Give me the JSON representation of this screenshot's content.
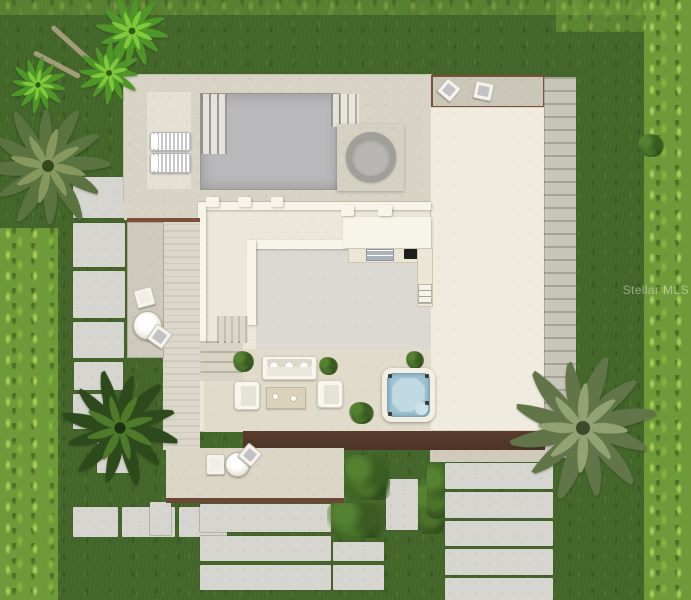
{
  "site": {
    "watermark": "Stellar MLS",
    "description": "Aerial 3D rendering of a modern single-family residence site plan",
    "areas": [
      "lawn",
      "pool-deck",
      "swimming-pool",
      "round-spa",
      "lounger-pad",
      "roof-terrace",
      "garage-wing",
      "main-residence",
      "outdoor-kitchen",
      "courtyard-lounge",
      "square-hot-tub",
      "entry-porch",
      "side-patio",
      "paver-walkway",
      "stepping-stone-path",
      "shrub-beds",
      "palm-trees"
    ],
    "furniture_counts": {
      "pool_loungers": 2,
      "terrace_chairs": 2,
      "courtyard_armchairs": 2,
      "courtyard_sofa": 1,
      "coffee_table": 1,
      "bistro_tables": 2,
      "bistro_chairs": 4,
      "potted_plants": 6
    },
    "tree_counts": {
      "bright_palms": 3,
      "olive_palms": 2,
      "dark_palm": 1
    }
  },
  "palette": {
    "grass_base": "#45682b",
    "grass_bright": "#6e9a39",
    "pool_deck": "#d7d3c5",
    "pool_water": "#b9b8ba",
    "house_floor": "#ece7d9",
    "house_wall": "#f7f4e9",
    "garage_roof": "#f0ebdf",
    "fascia_brown": "#4e3427",
    "border_brown": "#7d4e3a",
    "spa_blue": "#a0c5d3",
    "paver_gray": "#d6d5cf"
  }
}
